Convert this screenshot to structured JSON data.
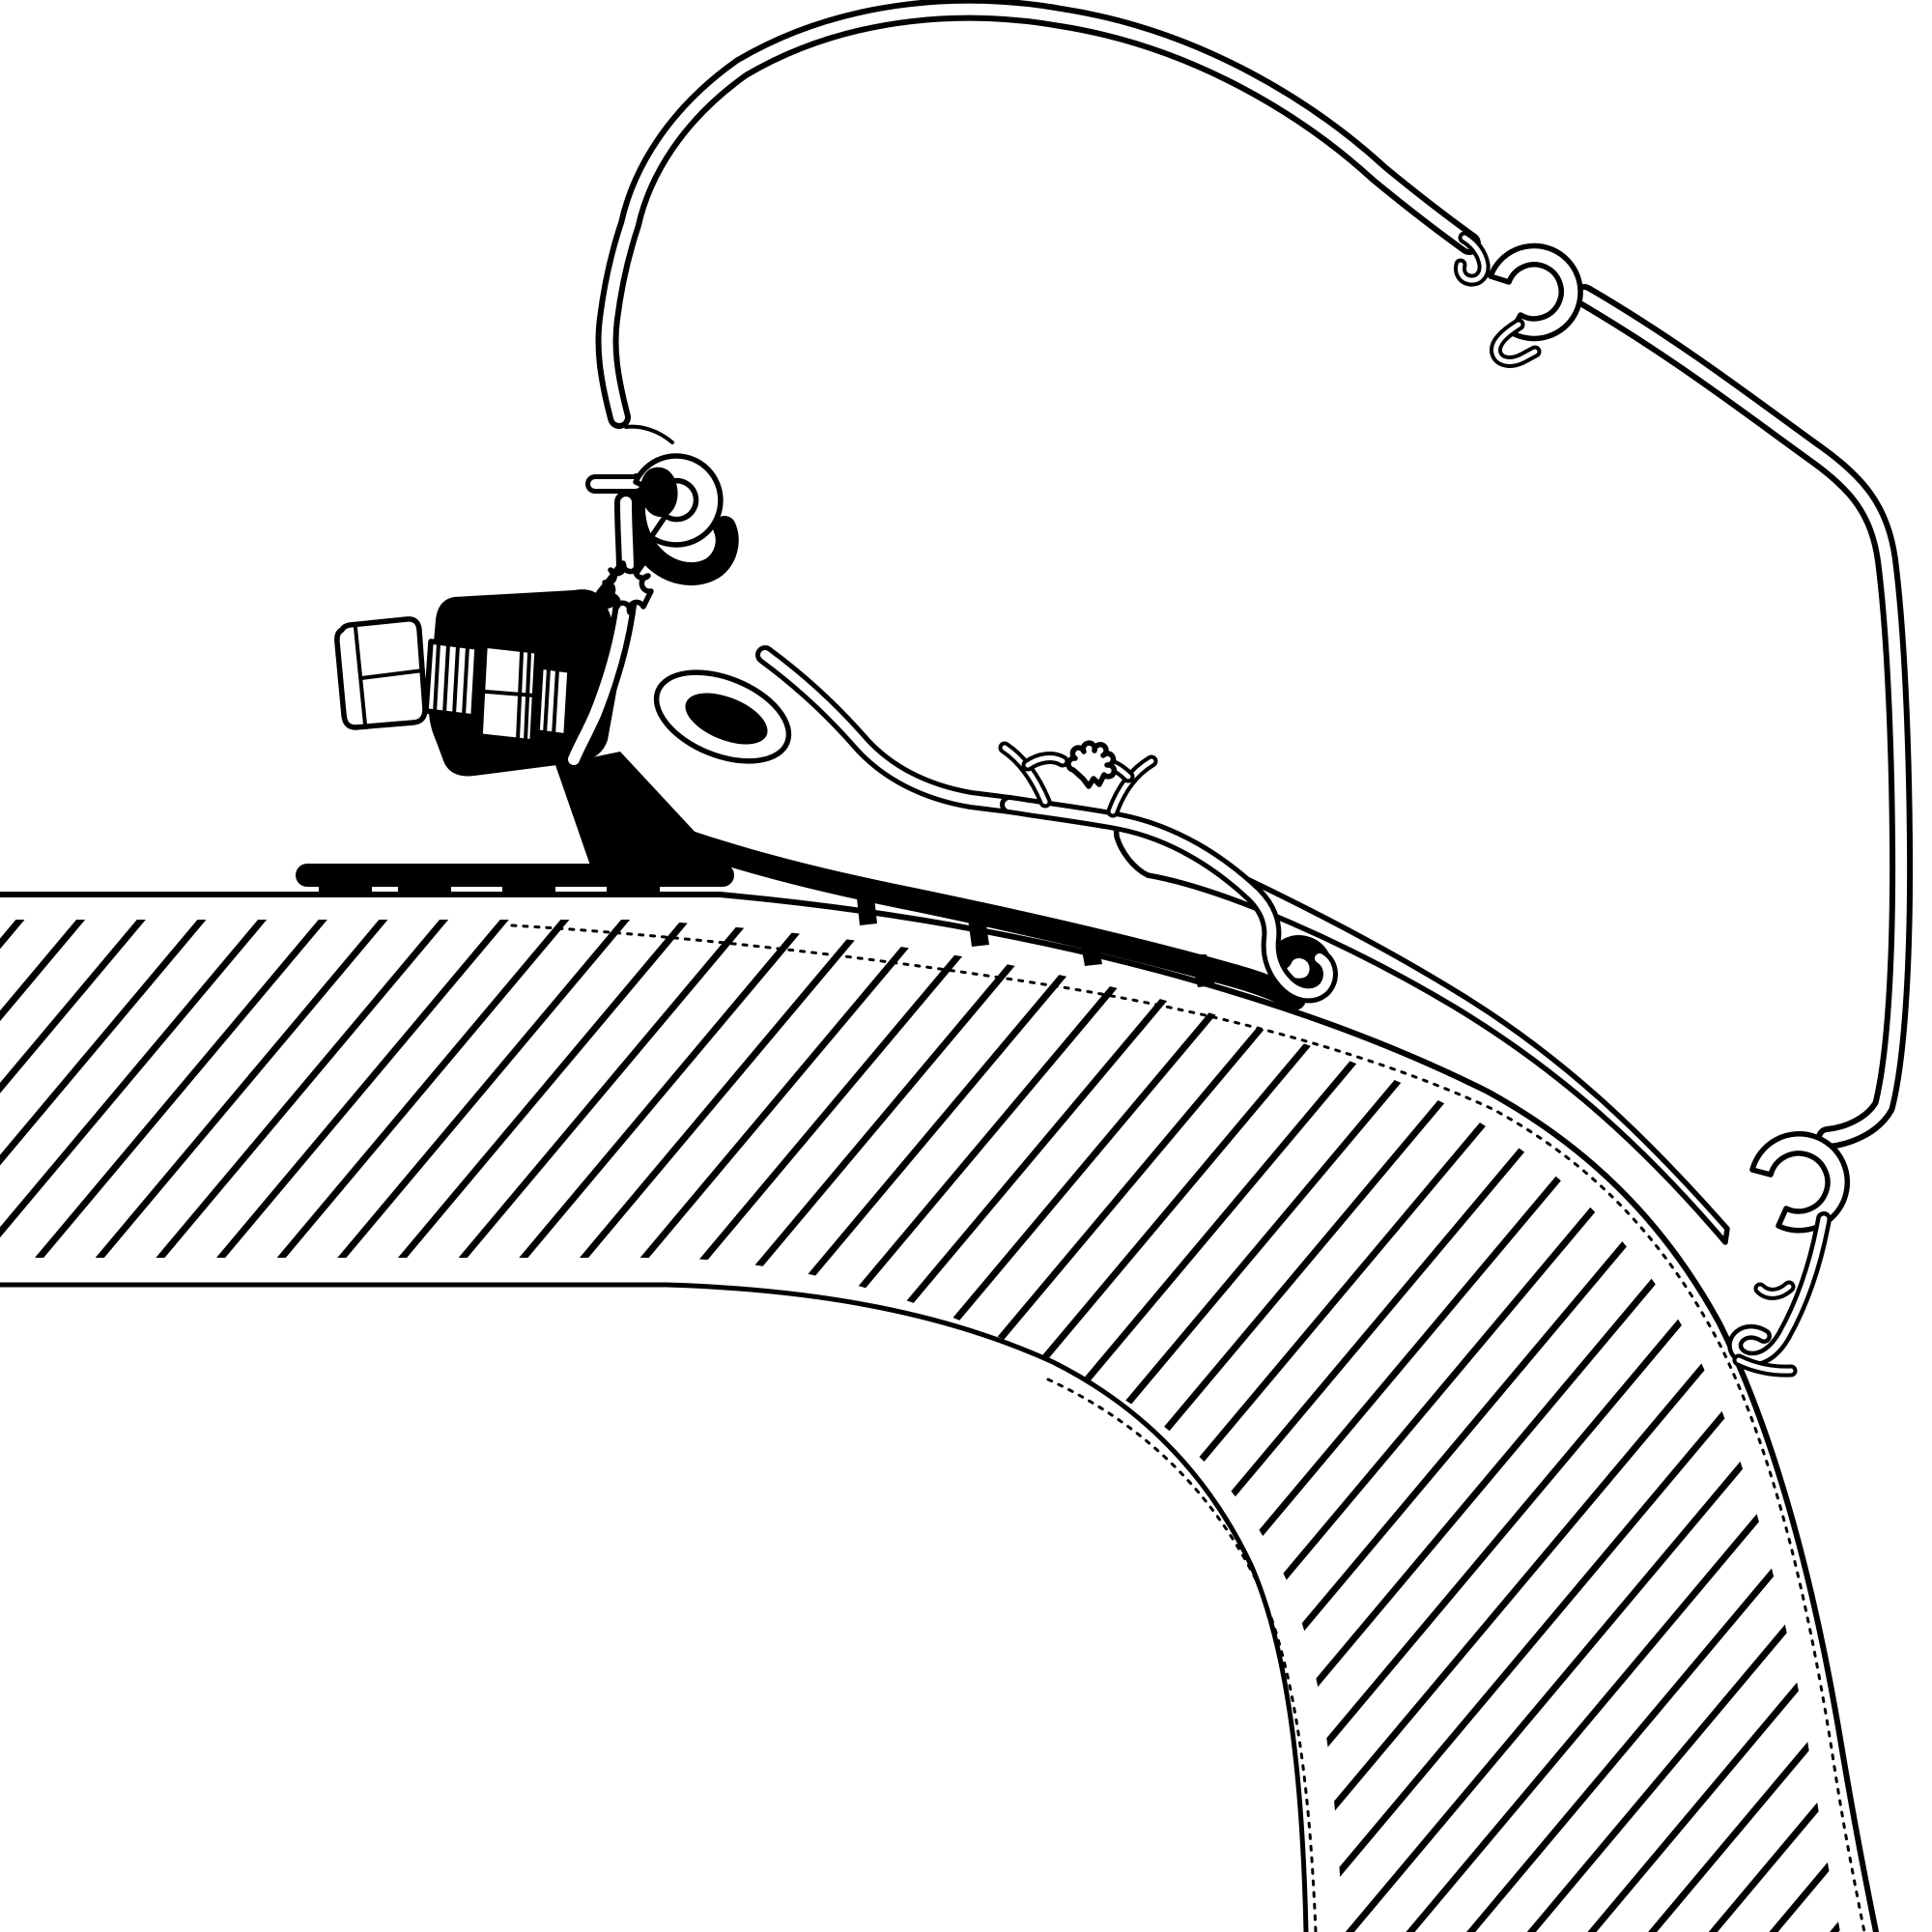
{
  "meta": {
    "title": "Awning adapter mounting diagram",
    "description": "Technical cross-section line drawing: awning rail profile with piping clips, black roof-adapter bracket with hex clamp bolt, mounted on a hatched caravan roof and wall panel"
  },
  "colors": {
    "background": "#ffffff",
    "line": "#000000"
  },
  "hatch": {
    "angle_deg": 40,
    "spacing_px": 48,
    "stroke_px": 7
  },
  "parts": [
    {
      "id": "awning-rail-profile",
      "label": "Awning rail profile"
    },
    {
      "id": "rail-mount-flange",
      "label": "Rail mounting flange with screw boss"
    },
    {
      "id": "top-piping-clip",
      "label": "Upper piping C-clip"
    },
    {
      "id": "bottom-piping-clip",
      "label": "Lower piping C-clip with end hook"
    },
    {
      "id": "adapter-bracket",
      "label": "Roof adapter bracket (solid section)"
    },
    {
      "id": "clamp-bolt",
      "label": "Hex clamp bolt with nut"
    },
    {
      "id": "roof-panel",
      "label": "Caravan roof / wall sandwich panel (hatched core)"
    }
  ]
}
